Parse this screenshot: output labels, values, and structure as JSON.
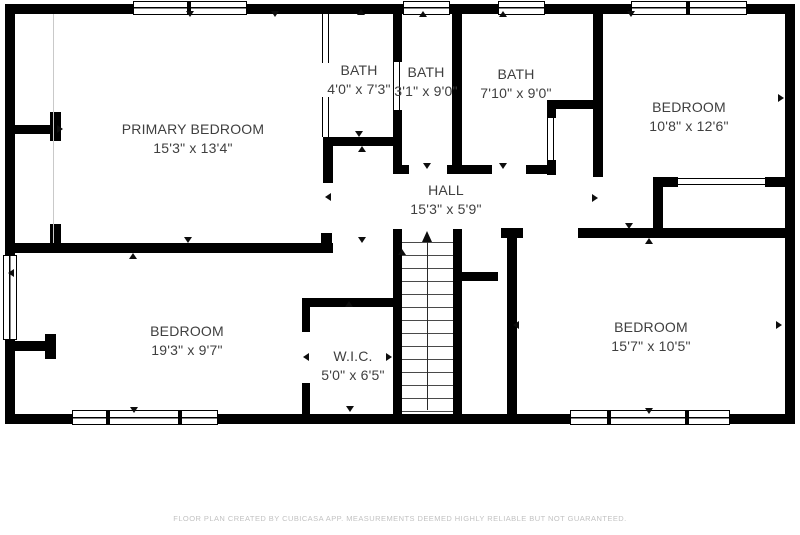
{
  "floor_plan": {
    "rooms": [
      {
        "name": "PRIMARY BEDROOM",
        "dims": "15'3\" x 13'4\""
      },
      {
        "name": "BATH",
        "dims": "4'0\" x 7'3\""
      },
      {
        "name": "BATH",
        "dims": "3'1\" x 9'0\""
      },
      {
        "name": "BATH",
        "dims": "7'10\" x 9'0\""
      },
      {
        "name": "BEDROOM",
        "dims": "10'8\" x 12'6\""
      },
      {
        "name": "HALL",
        "dims": "15'3\" x 5'9\""
      },
      {
        "name": "BEDROOM",
        "dims": "19'3\" x 9'7\""
      },
      {
        "name": "W.I.C.",
        "dims": "5'0\" x 6'5\""
      },
      {
        "name": "BEDROOM",
        "dims": "15'7\" x 10'5\""
      }
    ],
    "footer": "FLOOR PLAN CREATED BY CUBICASA APP. MEASUREMENTS DEEMED HIGHLY RELIABLE BUT NOT GUARANTEED.",
    "colors": {
      "wall": "#000000",
      "room_text": "#3f3f3f",
      "footer_text": "#c2c2c2"
    }
  }
}
